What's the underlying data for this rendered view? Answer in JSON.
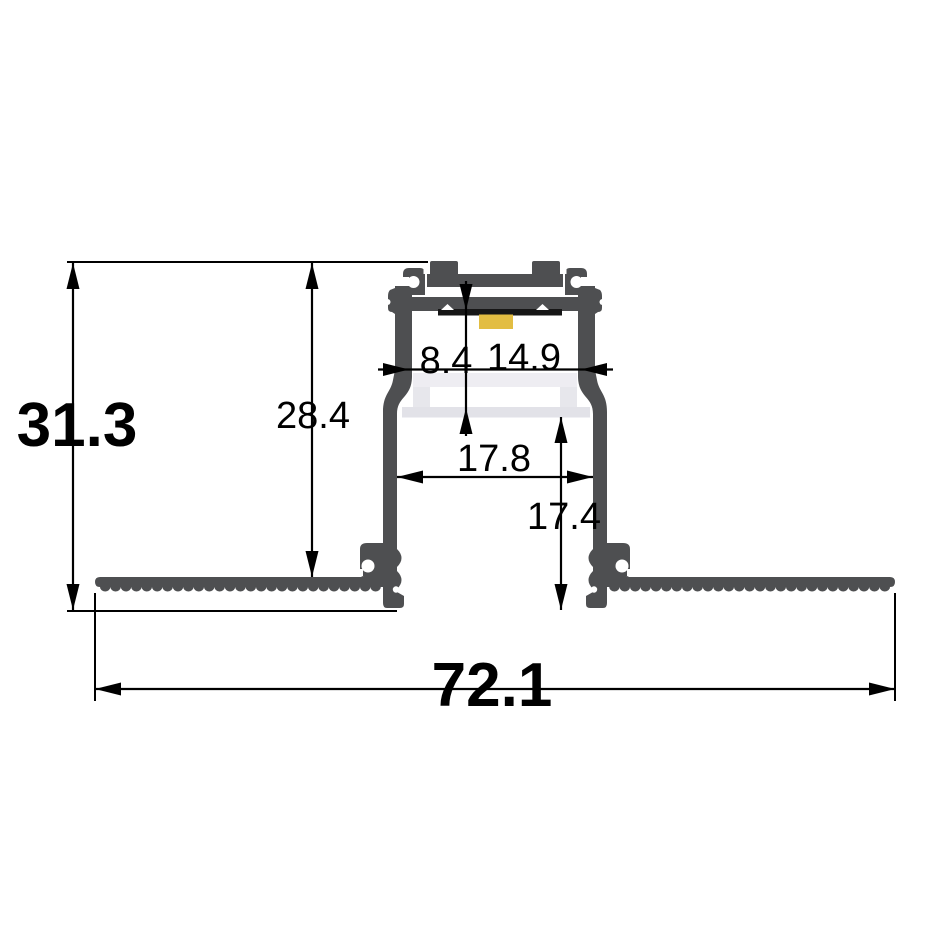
{
  "diagram": {
    "labels": {
      "overall_height": "31.3",
      "mounting_height": "28.4",
      "led_to_diffuser_gap": "8.4",
      "top_opening_width": "14.9",
      "inner_width": "17.8",
      "recess_depth": "17.4",
      "overall_width": "72.1"
    },
    "colors": {
      "aluminum": "#4e4f51",
      "diffuser_top": "#eeedf2",
      "diffuser_rim": "#e7e7ec",
      "diffuser_plate": "#e2e2e8",
      "led": "#e2bd42",
      "pcb": "#161616",
      "line": "#000000",
      "background": "#ffffff"
    }
  }
}
